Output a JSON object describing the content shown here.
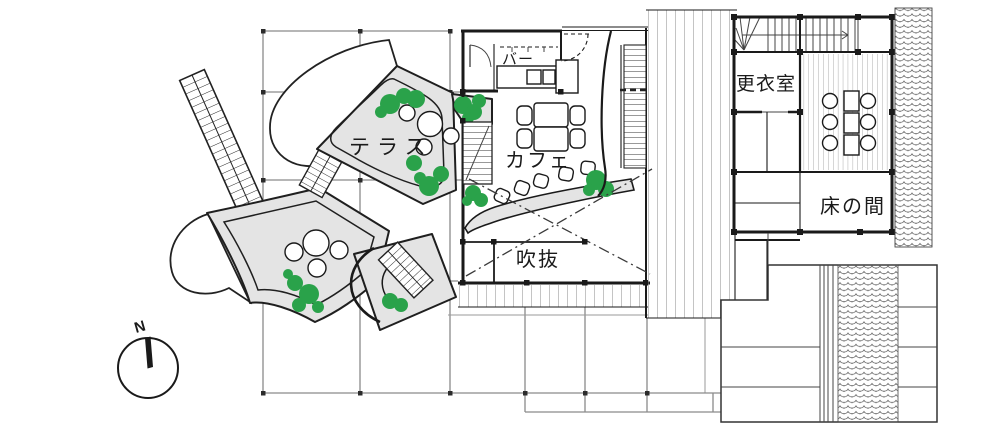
{
  "labels": {
    "terrace": "テラス",
    "cafe": "カフェ",
    "bar": "バー",
    "void": "吹抜",
    "changing_room": "更衣室",
    "alcove": "床の間"
  },
  "compass": {
    "north": "N"
  },
  "colors": {
    "line": "#1a1a1a",
    "grid": "#8a8a8a",
    "platform_fill": "#e4e4e4",
    "tree_green": "#2aa24a",
    "hatch": "#555555"
  }
}
